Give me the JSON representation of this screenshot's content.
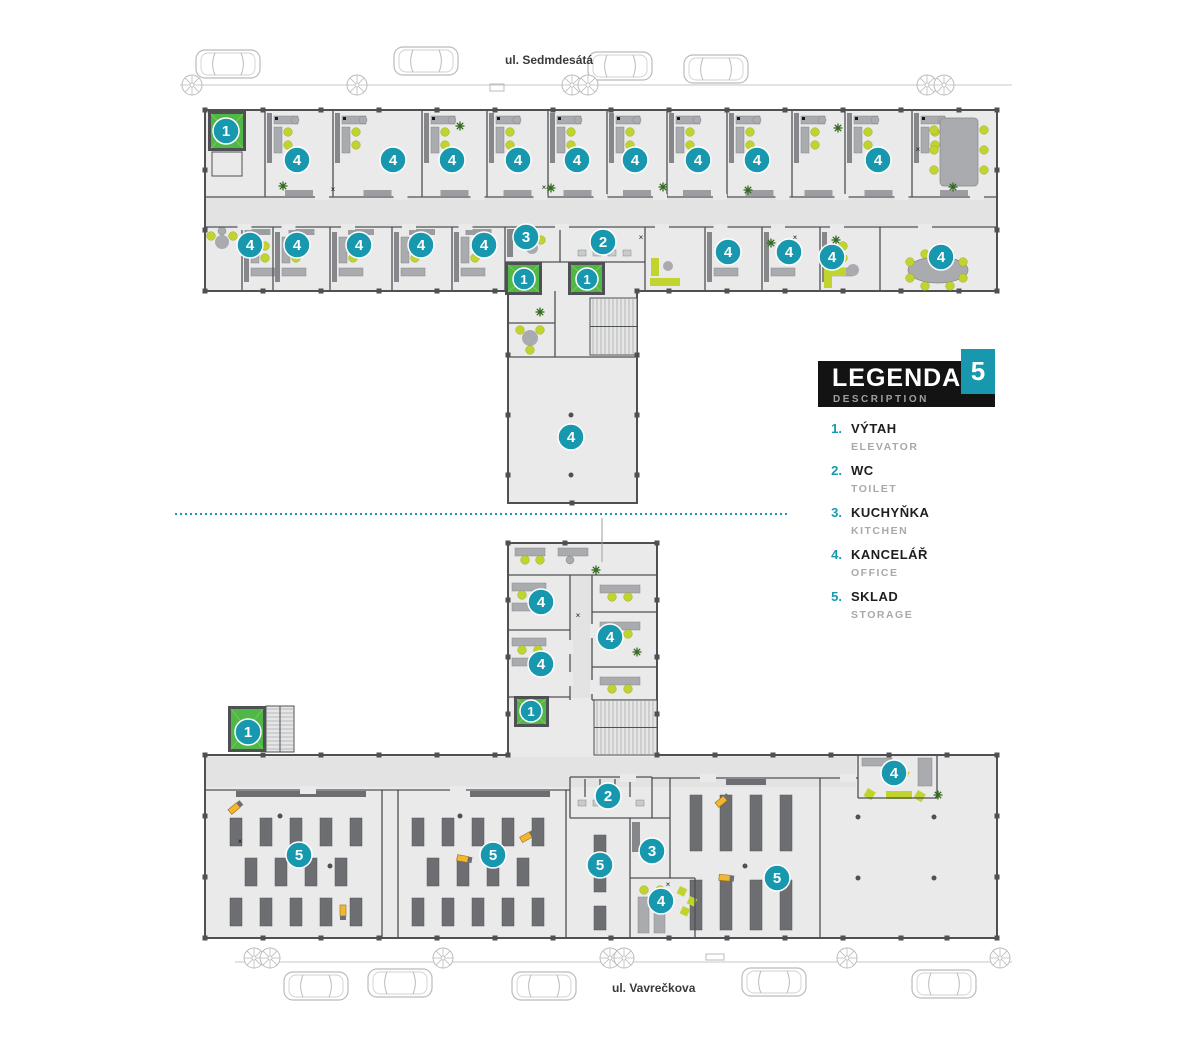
{
  "streets": {
    "top": {
      "label": "ul. Sedmdesátá"
    },
    "bottom": {
      "label": "ul. Vavrečkova"
    }
  },
  "legend": {
    "title": "LEGENDA",
    "subtitle": "DESCRIPTION",
    "floor_number": "5",
    "items": [
      {
        "num": "1.",
        "label": "VÝTAH",
        "sublabel": "ELEVATOR"
      },
      {
        "num": "2.",
        "label": "WC",
        "sublabel": "TOILET"
      },
      {
        "num": "3.",
        "label": "KUCHYŇKA",
        "sublabel": "KITCHEN"
      },
      {
        "num": "4.",
        "label": "KANCELÁŘ",
        "sublabel": "OFFICE"
      },
      {
        "num": "5.",
        "label": "SKLAD",
        "sublabel": "STORAGE"
      }
    ]
  },
  "badges": [
    {
      "n": "1",
      "x": 226,
      "y": 131
    },
    {
      "n": "4",
      "x": 297,
      "y": 160
    },
    {
      "n": "4",
      "x": 393,
      "y": 160
    },
    {
      "n": "4",
      "x": 452,
      "y": 160
    },
    {
      "n": "4",
      "x": 518,
      "y": 160
    },
    {
      "n": "4",
      "x": 577,
      "y": 160
    },
    {
      "n": "4",
      "x": 635,
      "y": 160
    },
    {
      "n": "4",
      "x": 698,
      "y": 160
    },
    {
      "n": "4",
      "x": 757,
      "y": 160
    },
    {
      "n": "4",
      "x": 878,
      "y": 160
    },
    {
      "n": "4",
      "x": 250,
      "y": 245
    },
    {
      "n": "4",
      "x": 297,
      "y": 245
    },
    {
      "n": "4",
      "x": 359,
      "y": 245
    },
    {
      "n": "4",
      "x": 421,
      "y": 245
    },
    {
      "n": "4",
      "x": 484,
      "y": 245
    },
    {
      "n": "3",
      "x": 526,
      "y": 237
    },
    {
      "n": "2",
      "x": 603,
      "y": 242
    },
    {
      "n": "4",
      "x": 728,
      "y": 252
    },
    {
      "n": "4",
      "x": 789,
      "y": 252
    },
    {
      "n": "4",
      "x": 832,
      "y": 257
    },
    {
      "n": "4",
      "x": 941,
      "y": 257
    },
    {
      "n": "1",
      "x": 524,
      "y": 279,
      "r": 11
    },
    {
      "n": "1",
      "x": 587,
      "y": 279,
      "r": 11
    },
    {
      "n": "4",
      "x": 571,
      "y": 437
    },
    {
      "n": "4",
      "x": 541,
      "y": 602
    },
    {
      "n": "4",
      "x": 610,
      "y": 637
    },
    {
      "n": "4",
      "x": 541,
      "y": 664
    },
    {
      "n": "1",
      "x": 531,
      "y": 711,
      "r": 11
    },
    {
      "n": "1",
      "x": 248,
      "y": 732
    },
    {
      "n": "2",
      "x": 608,
      "y": 796
    },
    {
      "n": "5",
      "x": 299,
      "y": 855
    },
    {
      "n": "5",
      "x": 493,
      "y": 855
    },
    {
      "n": "5",
      "x": 600,
      "y": 865
    },
    {
      "n": "3",
      "x": 652,
      "y": 851
    },
    {
      "n": "4",
      "x": 661,
      "y": 901
    },
    {
      "n": "5",
      "x": 777,
      "y": 878
    },
    {
      "n": "4",
      "x": 894,
      "y": 773
    }
  ],
  "elevators": [
    {
      "x": 208,
      "y": 111,
      "w": 38,
      "h": 40
    },
    {
      "x": 505,
      "y": 262,
      "w": 37,
      "h": 33
    },
    {
      "x": 568,
      "y": 262,
      "w": 37,
      "h": 33
    },
    {
      "x": 514,
      "y": 696,
      "w": 35,
      "h": 31
    },
    {
      "x": 228,
      "y": 706,
      "w": 38,
      "h": 46
    }
  ],
  "cars": {
    "top": [
      {
        "x": 196,
        "y": 50
      },
      {
        "x": 394,
        "y": 47
      },
      {
        "x": 588,
        "y": 52
      },
      {
        "x": 684,
        "y": 55
      }
    ],
    "bottom": [
      {
        "x": 284,
        "y": 972
      },
      {
        "x": 368,
        "y": 969
      },
      {
        "x": 512,
        "y": 972
      },
      {
        "x": 742,
        "y": 968
      },
      {
        "x": 912,
        "y": 970
      }
    ]
  },
  "trees": {
    "top": [
      192,
      357,
      572,
      588,
      927,
      944
    ],
    "bottom": [
      254,
      270,
      443,
      610,
      624,
      847,
      1000
    ]
  },
  "forklifts": [
    {
      "x": 236,
      "y": 807,
      "rot": -40
    },
    {
      "x": 465,
      "y": 859,
      "rot": 10
    },
    {
      "x": 343,
      "y": 913,
      "rot": 90
    },
    {
      "x": 528,
      "y": 836,
      "rot": -30
    },
    {
      "x": 723,
      "y": 800,
      "rot": -40
    },
    {
      "x": 727,
      "y": 878,
      "rot": 5
    }
  ],
  "plants": [
    [
      283,
      186
    ],
    [
      460,
      126
    ],
    [
      551,
      188
    ],
    [
      663,
      187
    ],
    [
      748,
      190
    ],
    [
      838,
      128
    ],
    [
      953,
      187
    ],
    [
      836,
      240
    ],
    [
      540,
      312
    ],
    [
      596,
      570
    ],
    [
      637,
      652
    ],
    [
      938,
      795
    ],
    [
      771,
      243
    ]
  ],
  "colors": {
    "teal": "#1798ae",
    "green": "#4fb848",
    "green_light": "#7dc94f",
    "wall": "#4f5054",
    "floor": "#eaeaea",
    "floor_dark": "#e3e3e3",
    "furniture": "#a9abae",
    "furniture_dark": "#85878a",
    "chair": "#c1d32f",
    "rack": "#6d6e71",
    "outline": "#b9bbbd",
    "forklift": "#f2b632",
    "plant": "#33691e",
    "text_dark": "#1e1e1e",
    "text_gray": "#a7a9ac"
  }
}
